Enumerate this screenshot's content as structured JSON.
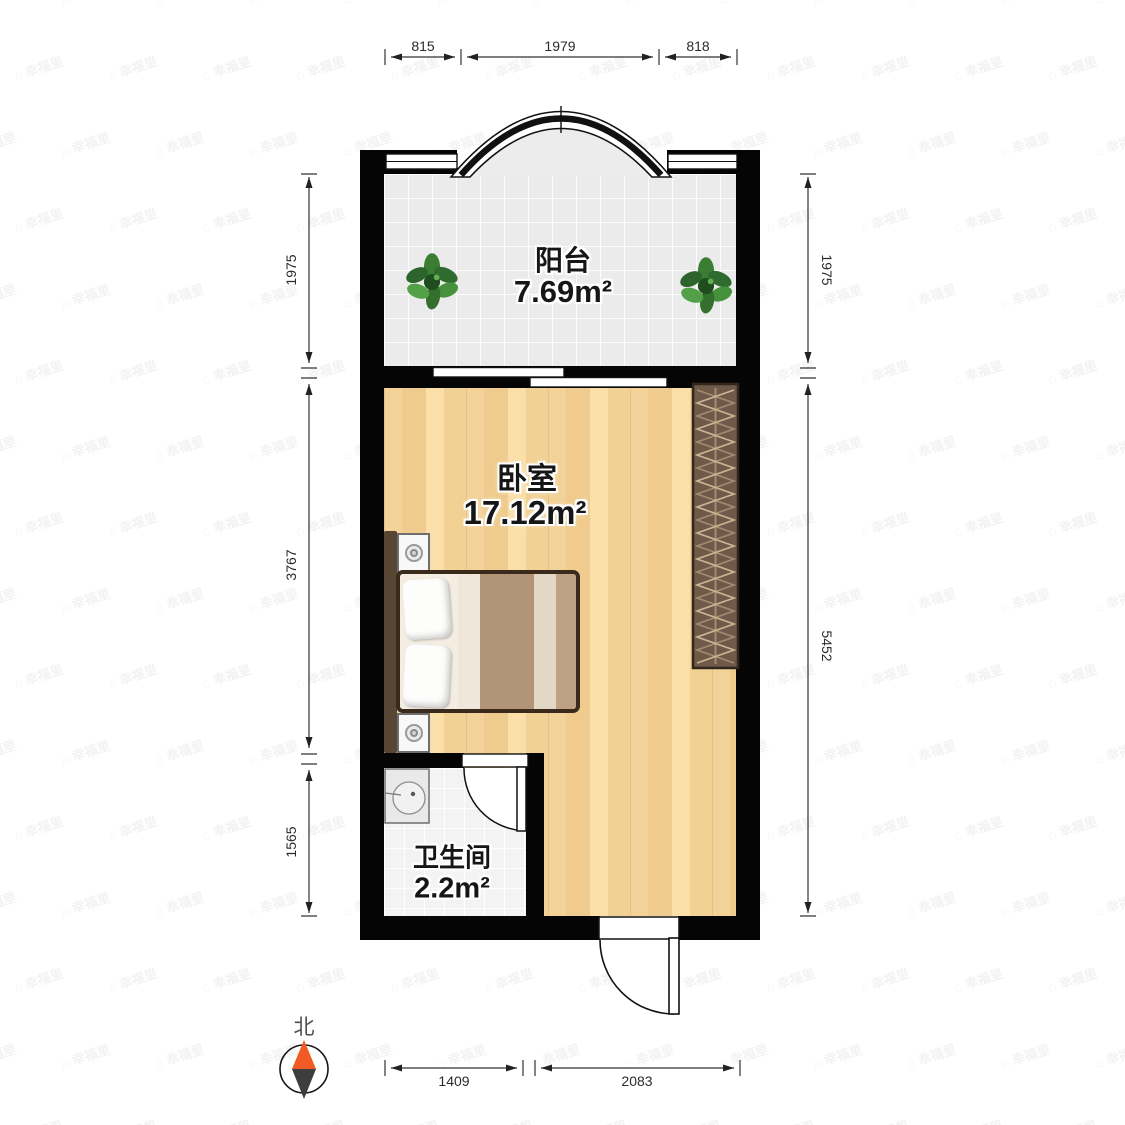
{
  "rooms": [
    {
      "id": "balcony",
      "name": "阳台",
      "area": "7.69m²"
    },
    {
      "id": "bedroom",
      "name": "卧室",
      "area": "17.12m²"
    },
    {
      "id": "bathroom",
      "name": "卫生间",
      "area": "2.2m²"
    }
  ],
  "dimensions": {
    "top": [
      "815",
      "1979",
      "818"
    ],
    "left": [
      "1975",
      "3767",
      "1565"
    ],
    "right": [
      "1975",
      "5452"
    ],
    "bottom": [
      "1409",
      "2083"
    ]
  },
  "compass": {
    "label": "北"
  },
  "watermark": {
    "icon": "⌂",
    "text": "幸福里"
  },
  "colors": {
    "wall": "#050505",
    "wood": "#f2d298",
    "tile": "#ebebeb",
    "wardrobe": "#6f5948",
    "bed_stripe": "#b29478",
    "plant": "#3a7d33",
    "compass_north": "#f15a24",
    "dim_text": "#2b2b2b"
  }
}
